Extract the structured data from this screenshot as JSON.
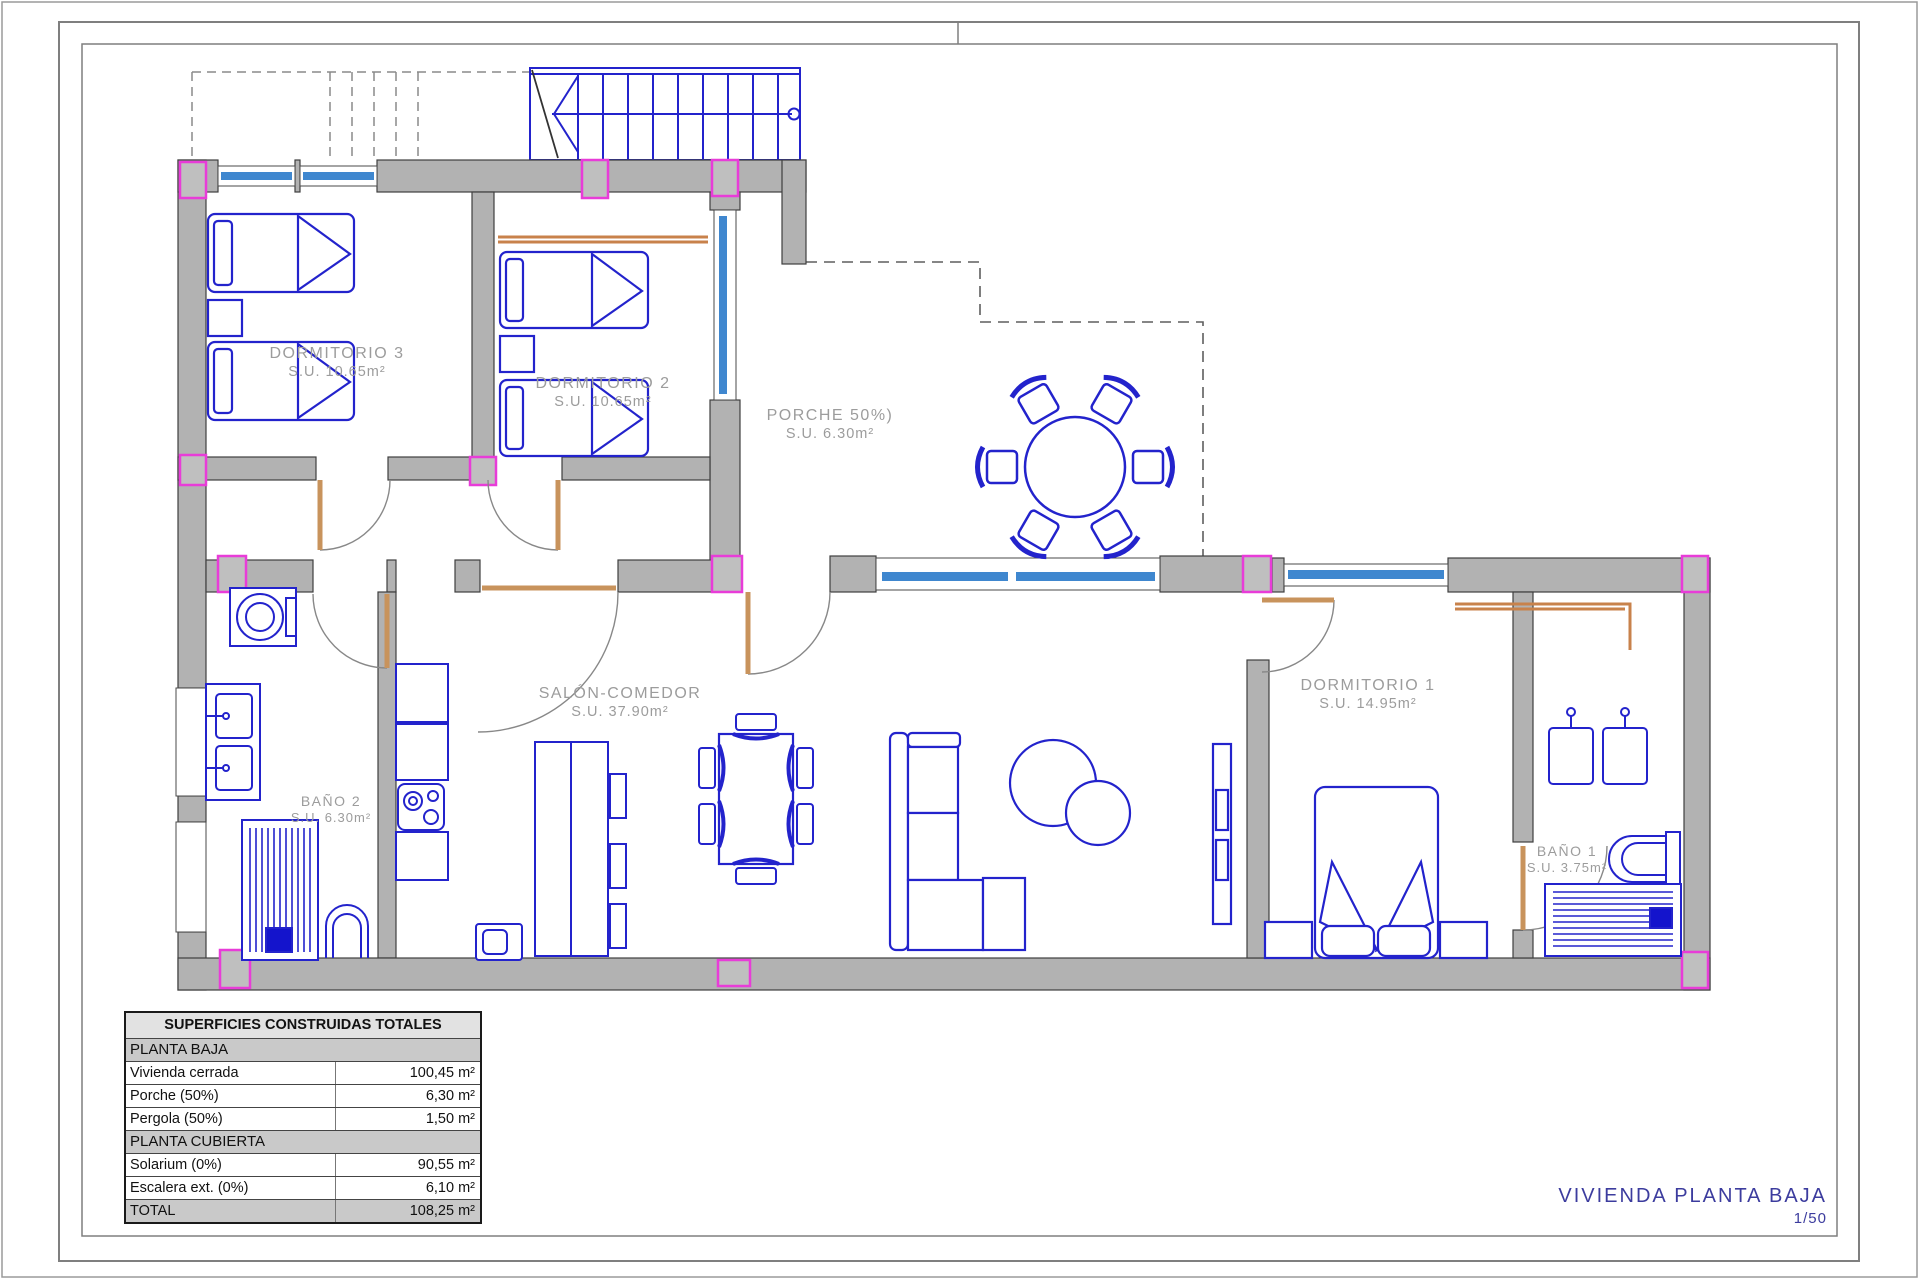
{
  "document": {
    "title_block": {
      "title": "VIVIENDA PLANTA BAJA",
      "scale": "1/50"
    }
  },
  "rooms": [
    {
      "id": "dormitorio3",
      "name": "DORMITORIO 3",
      "area": "S.U. 10.65m²"
    },
    {
      "id": "dormitorio2",
      "name": "DORMITORIO 2",
      "area": "S.U. 10.65m²"
    },
    {
      "id": "porche",
      "name": "PORCHE 50%)",
      "area": "S.U. 6.30m²"
    },
    {
      "id": "salon",
      "name": "SALÓN-COMEDOR",
      "area": "S.U. 37.90m²"
    },
    {
      "id": "dormitorio1",
      "name": "DORMITORIO 1",
      "area": "S.U. 14.95m²"
    },
    {
      "id": "bano2",
      "name": "BAÑO 2",
      "area": "S.U. 6.30m²"
    },
    {
      "id": "bano1",
      "name": "BAÑO 1",
      "area": "S.U. 3.75m²"
    }
  ],
  "areas_table": {
    "title": "SUPERFICIES CONSTRUIDAS TOTALES",
    "sections": [
      {
        "header": "PLANTA BAJA",
        "rows": [
          [
            "Vivienda cerrada",
            "100,45 m²"
          ],
          [
            "Porche (50%)",
            "6,30 m²"
          ],
          [
            "Pergola (50%)",
            "1,50 m²"
          ]
        ]
      },
      {
        "header": "PLANTA CUBIERTA",
        "rows": [
          [
            "Solarium (0%)",
            "90,55 m²"
          ],
          [
            "Escalera ext. (0%)",
            "6,10 m²"
          ]
        ]
      }
    ],
    "total": {
      "label": "TOTAL",
      "value": "108,25 m²"
    }
  },
  "colors": {
    "wall_gray": "#b2b2b2",
    "wall_outline": "#3f3f3f",
    "furniture_blue": "#2323cc",
    "window_blue": "#3f87cf",
    "pillar_magenta": "#e83cd8",
    "door_tan": "#c8935c",
    "closet_orange": "#c8824b",
    "label_gray": "#9c9c9c",
    "title_blue": "#3c3c9e"
  }
}
